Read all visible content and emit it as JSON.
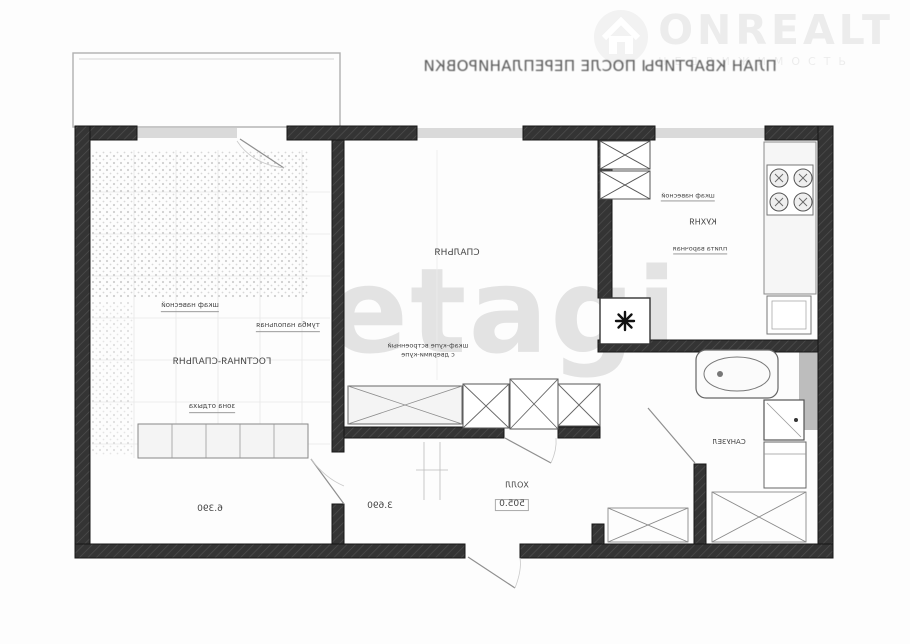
{
  "header": {
    "title": "ПЛАН КВАРТИРЫ ПОСЛЕ ПЕРЕПЛАНИРОВКИ",
    "mirrored": true
  },
  "watermarks": {
    "onrealt_brand": "ONREALT",
    "onrealt_subtitle": "НЕДВИЖИМОСТЬ",
    "etagi": "etagi"
  },
  "icons": {
    "brand_logo": "house-icon",
    "fridge_symbol": "snowflake-asterisk",
    "stove": "four-burner-hob",
    "bathtub": "oval-tub"
  },
  "plan": {
    "rooms": {
      "living": "ГОСТИНАЯ-СПАЛЬНЯ",
      "bedroom": "СПАЛЬНЯ",
      "kitchen": "КУХНЯ",
      "hall": "ХОЛЛ",
      "bathroom": "САНУЗЕЛ"
    },
    "notes": {
      "living_note_1": "шкаф навесной",
      "living_note_2": "тумба напольная",
      "living_note_3": "зона отдыха",
      "bedroom_note_1": "шкаф-купе встроенный",
      "bedroom_note_2": "с дверями-купе",
      "kitchen_note_1": "шкаф навесной",
      "kitchen_note_2": "плита варочная"
    },
    "dimensions": {
      "d_living": "6.390",
      "d_mid": "3.690",
      "d_hall": "505.0"
    },
    "fridge_glyph": "✳"
  },
  "colors": {
    "wall": "#343434",
    "window_band": "#dadada",
    "watermark_gray": "#e3e3e3",
    "label_text": "#454545"
  }
}
